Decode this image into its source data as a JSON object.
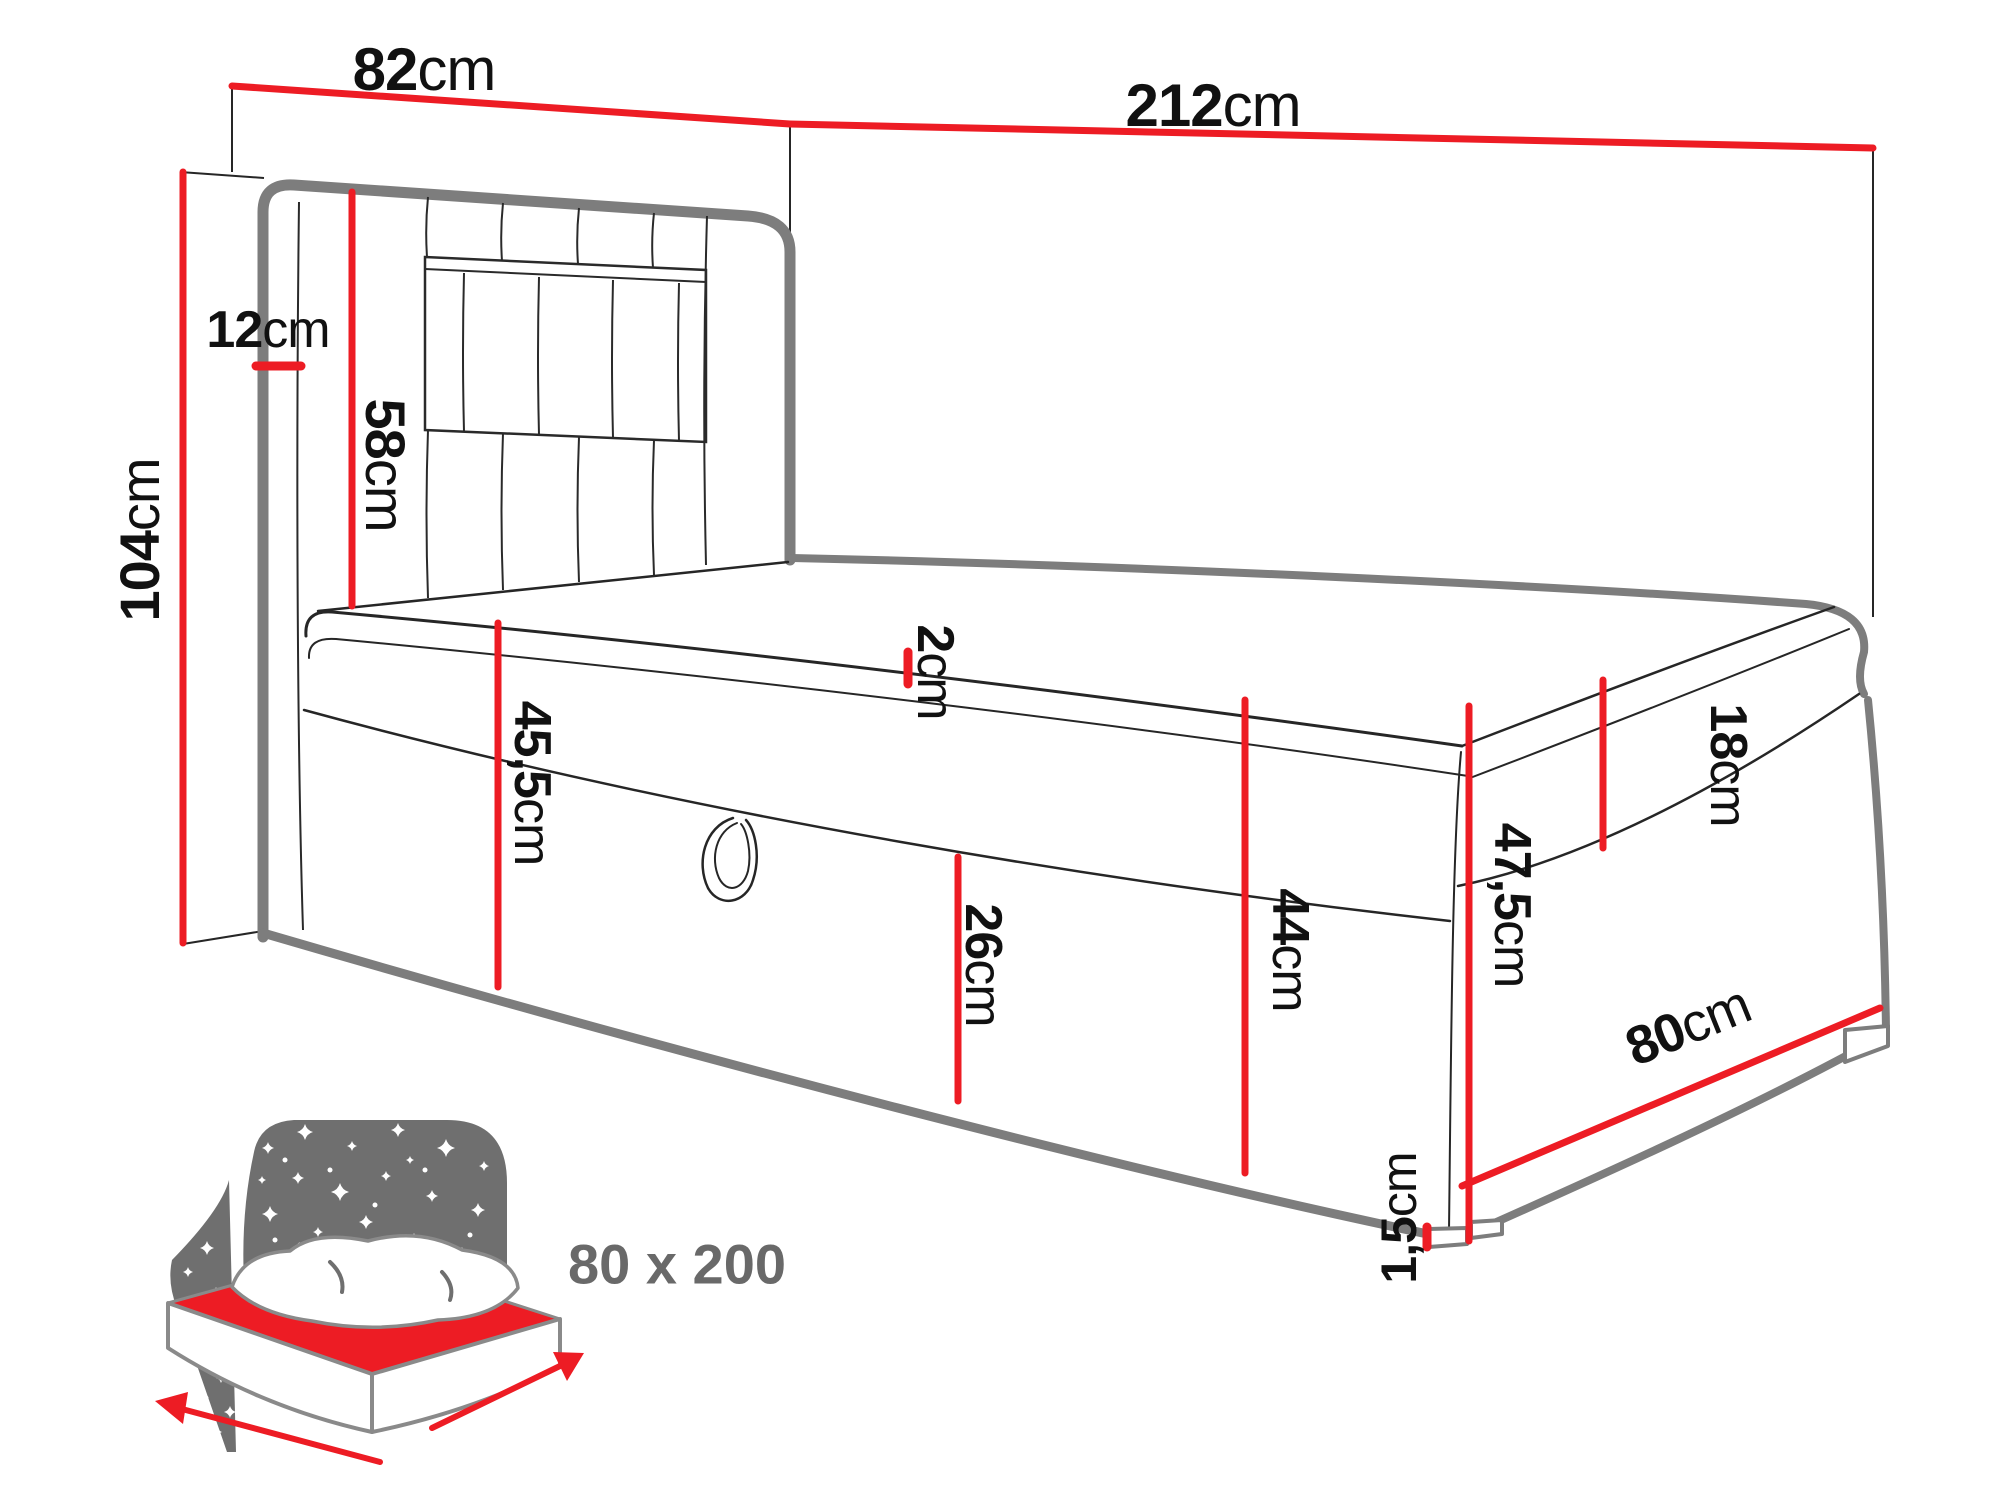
{
  "diagram": {
    "type": "boxspring-bed-dimension-diagram",
    "unit": "cm"
  },
  "dims": {
    "headboard_width": {
      "num": "82",
      "unit": "cm"
    },
    "total_length": {
      "num": "212",
      "unit": "cm"
    },
    "total_height": {
      "num": "104",
      "unit": "cm"
    },
    "headboard_depth": {
      "num": "12",
      "unit": "cm"
    },
    "headboard_panel": {
      "num": "58",
      "unit": "cm"
    },
    "topper": {
      "num": "2",
      "unit": "cm"
    },
    "side_front": {
      "num": "45,5",
      "unit": "cm"
    },
    "storage_flap": {
      "num": "26",
      "unit": "cm"
    },
    "base_side": {
      "num": "44",
      "unit": "cm"
    },
    "mattress": {
      "num": "18",
      "unit": "cm"
    },
    "foot_end": {
      "num": "47,5",
      "unit": "cm"
    },
    "legs": {
      "num": "1,5",
      "unit": "cm"
    },
    "width_foot": {
      "num": "80",
      "unit": "cm"
    }
  },
  "icon": {
    "size_label": "80 x 200"
  },
  "colors": {
    "dimension_red": "#ed1c24",
    "outline_gray": "#7d7d7d",
    "detail_black": "#262626",
    "icon_gray": "#6f6f6f",
    "label_black": "#111111",
    "size_text_gray": "#696969"
  }
}
